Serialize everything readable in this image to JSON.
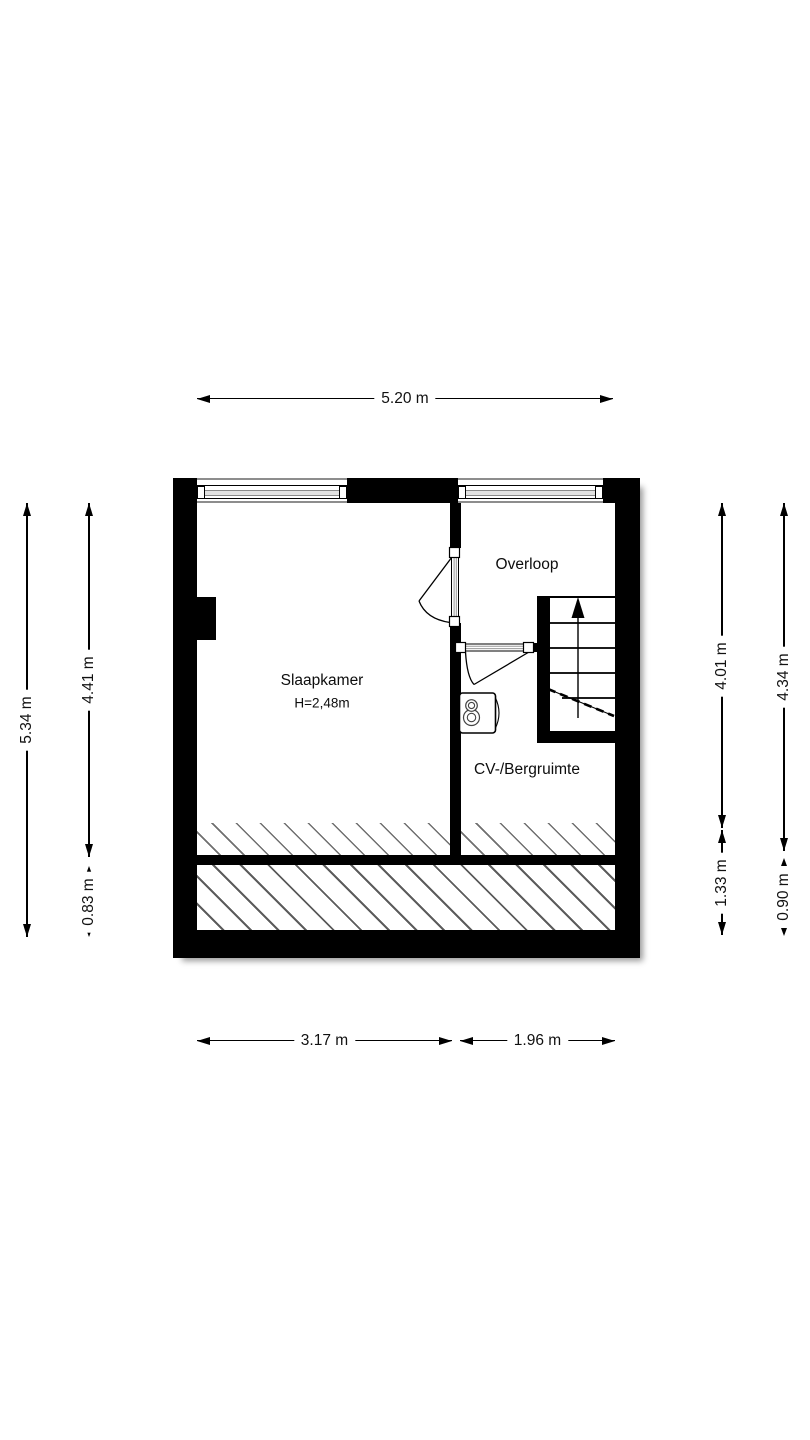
{
  "floorplan": {
    "rooms": [
      {
        "name": "Slaapkamer",
        "ceiling_height": "H=2,48m"
      },
      {
        "name": "Overloop"
      },
      {
        "name": "CV-/Bergruimte"
      }
    ],
    "dimensions": {
      "top_width": "5.20 m",
      "bottom_width_left": "3.17 m",
      "bottom_width_right": "1.96 m",
      "left_outer_height": "5.34 m",
      "left_inner_upper": "4.41 m",
      "left_inner_lower": "0.83 m",
      "right_inner_upper": "4.01 m",
      "right_inner_lower": "1.33 m",
      "right_outer_upper": "4.34 m",
      "right_outer_lower": "0.90 m"
    },
    "icons": {
      "stairs": "staircase-up-arrow",
      "boiler": "cv-boiler",
      "window": "double-glazed-window",
      "door": "swing-door"
    },
    "colors": {
      "wall": "#000000",
      "background": "#ffffff",
      "hatch_line": "#6f6f6f",
      "window_glass": "#9a9a9a"
    }
  }
}
